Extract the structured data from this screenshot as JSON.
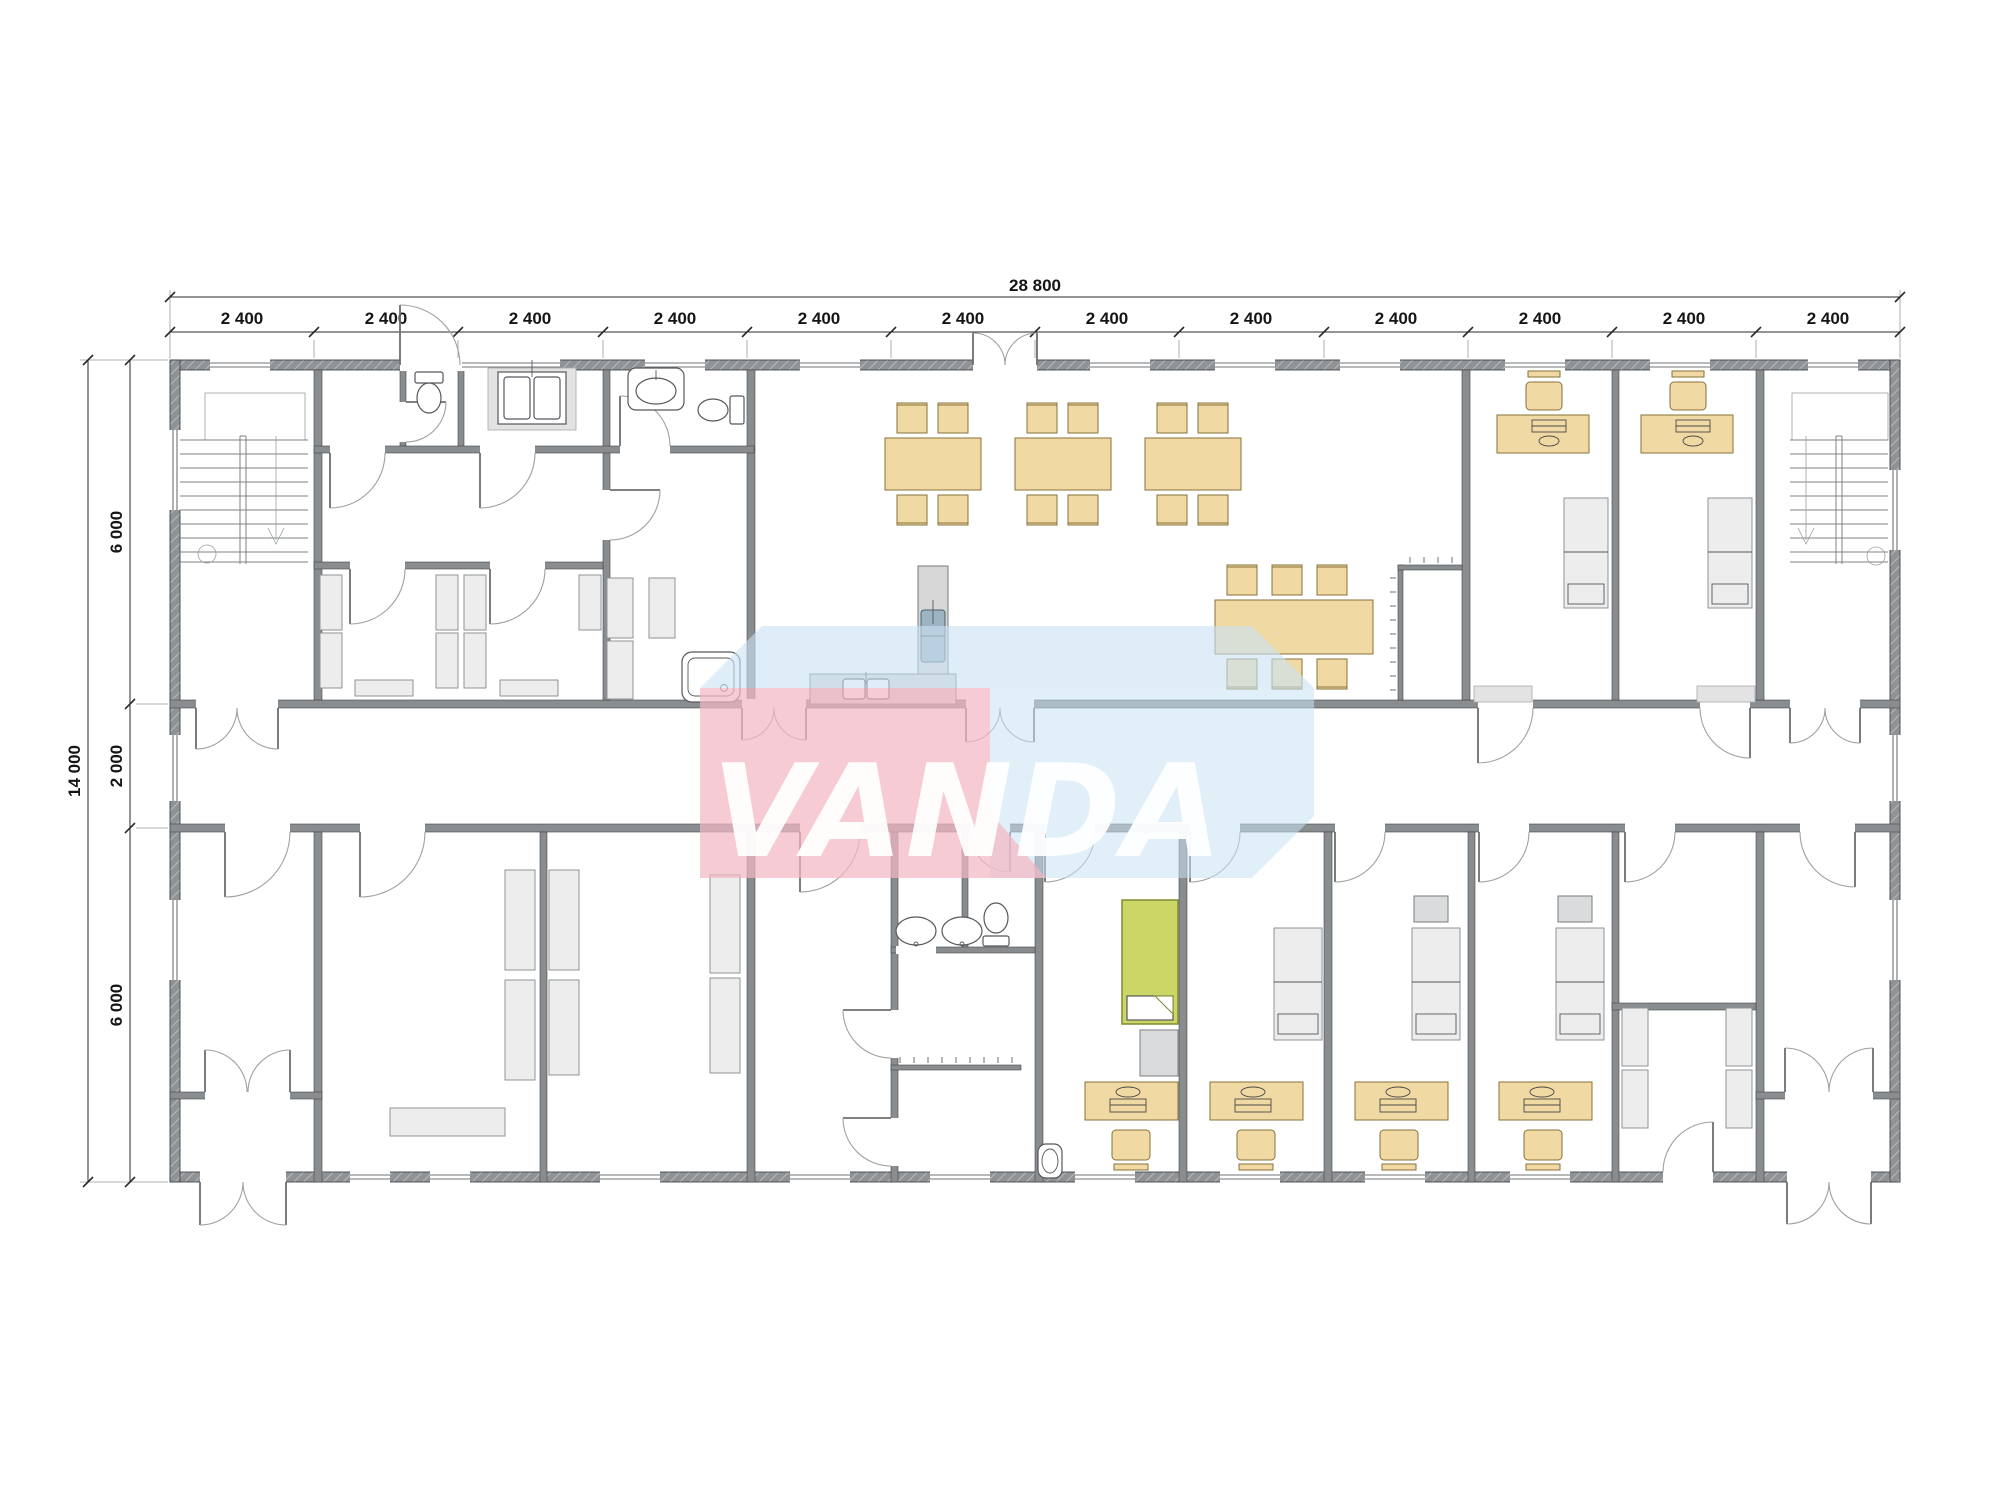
{
  "watermark": {
    "text": "VANDA",
    "front_color": "#f3b7c3",
    "top_color": "#c9e2f2",
    "side_color": "#c9e2f2",
    "text_color": "#ffffff"
  },
  "dimensions": {
    "total_width": "28 800",
    "total_height": "14 000",
    "top_modules": [
      "2 400",
      "2 400",
      "2 400",
      "2 400",
      "2 400",
      "2 400",
      "2 400",
      "2 400",
      "2 400",
      "2 400",
      "2 400",
      "2 400"
    ],
    "left_segments": [
      "6 000",
      "2 000",
      "6 000"
    ]
  },
  "colors": {
    "wall": "#898d90",
    "wall_edge": "#43464a",
    "furniture_tan": "#f1d9a3",
    "furniture_tan_border": "#86713a",
    "furniture_grey": "#ededed",
    "counter_grey": "#d7d7d7",
    "bed_green": "#ccd666",
    "bed_green_border": "#7f8b2f",
    "sink_blue": "#9db4c4",
    "dimension_text": "#151515"
  },
  "icons": {
    "stairs-icon": "parallel treads with center rail, down arrow and start circle",
    "toilet-icon": "tank rectangle with oval bowl",
    "sink-icon": "rounded basin with faucet dot",
    "shower-tray-icon": "rounded square with drain circle",
    "washer-icon": "square unit with two drums on mat",
    "dining-table-icon": "tan rectangle with chairs",
    "desk-icon": "tan rectangle with keyboard and mouse",
    "chair-icon": "seat square with backrest bar",
    "bed-icon": "rectangle with mattress split",
    "door-swing-icon": "quarter-circle arc with leaf line",
    "window-icon": "white wall gap with twin glazing lines"
  }
}
